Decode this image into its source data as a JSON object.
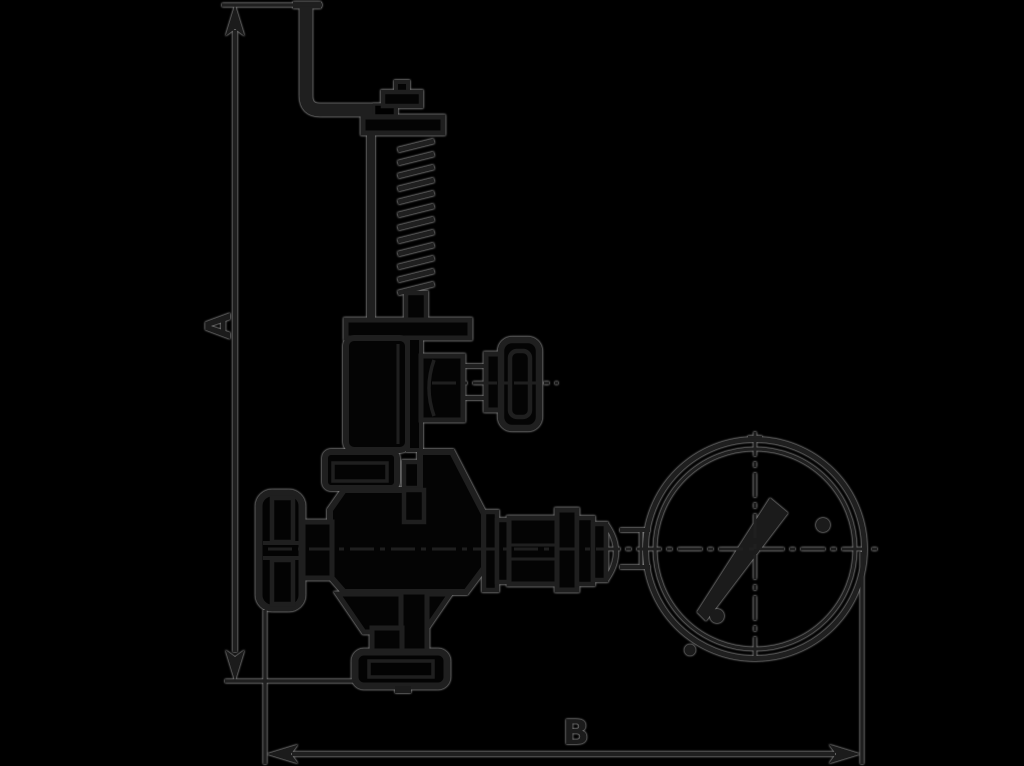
{
  "page": {
    "background_color": "#000000",
    "ink_color": "#1f1f1f",
    "halo_color": "#8f8f8f"
  },
  "drawing": {
    "kind": "technical-line-drawing",
    "subject": "spring safety valve with test lever, side knob, handwheel, outlet flange and pressure gauge",
    "dimensions": {
      "vertical_label": "A",
      "horizontal_label": "B"
    },
    "components": [
      "test-lever",
      "spindle-cap",
      "spring",
      "guide-rod",
      "bonnet",
      "side-knob",
      "handwheel",
      "valve-body",
      "outlet-flange",
      "fitting-train",
      "pressure-gauge",
      "gauge-needle"
    ]
  }
}
